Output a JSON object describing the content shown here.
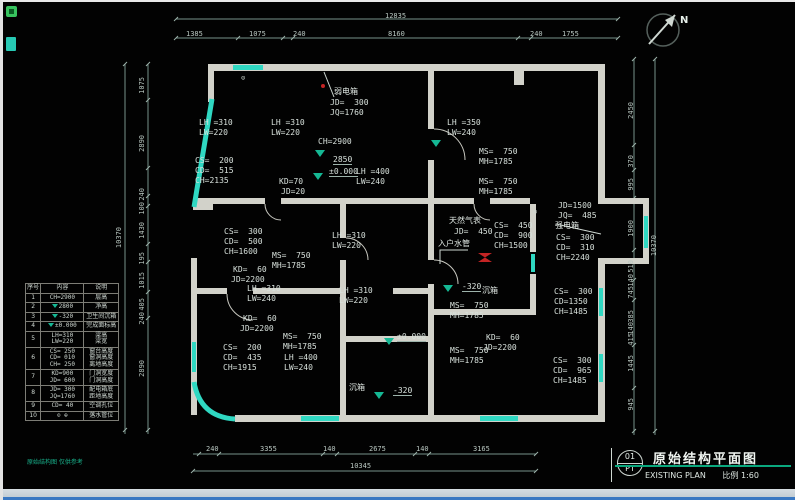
{
  "colors": {
    "background": "#020202",
    "wall": "#d2d2ca",
    "teal_accent": "#2fd8c2",
    "dim_line": "#77928a",
    "dim_text": "#b9c7c1",
    "level_green": "#15b894",
    "title_green": "#0aa87e",
    "alert_red": "#c42424"
  },
  "titleblock": {
    "number": "01",
    "code": "PT",
    "title_cn": "原始结构平面图",
    "title_en": "EXISTING PLAN",
    "scale_label": "比例 1:60"
  },
  "legend": {
    "headers": [
      "序号",
      "内容",
      "说明"
    ],
    "rows": [
      {
        "no": "1",
        "icon": null,
        "content": [
          "CH=2900"
        ],
        "desc": [
          "层高"
        ]
      },
      {
        "no": "2",
        "icon": "level-triangle",
        "content": [
          "2800"
        ],
        "desc": [
          "净高"
        ]
      },
      {
        "no": "3",
        "icon": "level-triangle",
        "content": [
          "-320"
        ],
        "desc": [
          "卫生间沉箱"
        ]
      },
      {
        "no": "4",
        "icon": "level-triangle",
        "content": [
          "±0.000"
        ],
        "desc": [
          "完成面标高"
        ]
      },
      {
        "no": "5",
        "icon": null,
        "content": [
          "LH=310",
          "LW=220"
        ],
        "desc": [
          "梁高",
          "梁宽"
        ]
      },
      {
        "no": "6",
        "icon": null,
        "content": [
          "CS= 250",
          "CD= 010",
          "CH= 250"
        ],
        "desc": [
          "窗台高度",
          "窗洞高度",
          "离地高度"
        ]
      },
      {
        "no": "7",
        "icon": null,
        "content": [
          "KD=900",
          "JD= 600"
        ],
        "desc": [
          "门洞宽度",
          "门洞高度"
        ]
      },
      {
        "no": "8",
        "icon": null,
        "content": [
          "JD= 300",
          "JQ=1760"
        ],
        "desc": [
          "配电箱底",
          "距地高度"
        ]
      },
      {
        "no": "9",
        "icon": null,
        "content": [
          "CD= 40"
        ],
        "desc": [
          "空调孔位"
        ]
      },
      {
        "no": "10",
        "icon": null,
        "content": [
          "⊙ ⊕"
        ],
        "desc": [
          "落水管位"
        ]
      }
    ],
    "note": "原始结构图 仅供参考"
  },
  "labels": [
    {
      "t": "12835",
      "x": 382,
      "y": 10,
      "c": "dim",
      "n": "dim-top-total"
    },
    {
      "t": "1385",
      "x": 183,
      "y": 28,
      "c": "dim",
      "n": "dim-top"
    },
    {
      "t": "1075",
      "x": 246,
      "y": 28,
      "c": "dim",
      "n": "dim-top"
    },
    {
      "t": "240",
      "x": 290,
      "y": 28,
      "c": "dim",
      "n": "dim-top"
    },
    {
      "t": "8160",
      "x": 385,
      "y": 28,
      "c": "dim",
      "n": "dim-top"
    },
    {
      "t": "240",
      "x": 527,
      "y": 28,
      "c": "dim",
      "n": "dim-top"
    },
    {
      "t": "1755",
      "x": 559,
      "y": 28,
      "c": "dim",
      "n": "dim-top"
    },
    {
      "t": "240",
      "x": 203,
      "y": 443,
      "c": "dim",
      "n": "dim-bottom"
    },
    {
      "t": "3355",
      "x": 257,
      "y": 443,
      "c": "dim",
      "n": "dim-bottom"
    },
    {
      "t": "140",
      "x": 320,
      "y": 443,
      "c": "dim",
      "n": "dim-bottom"
    },
    {
      "t": "2675",
      "x": 366,
      "y": 443,
      "c": "dim",
      "n": "dim-bottom"
    },
    {
      "t": "140",
      "x": 413,
      "y": 443,
      "c": "dim",
      "n": "dim-bottom"
    },
    {
      "t": "3165",
      "x": 470,
      "y": 443,
      "c": "dim",
      "n": "dim-bottom"
    },
    {
      "t": "10345",
      "x": 347,
      "y": 460,
      "c": "dim",
      "n": "dim-bottom-total"
    },
    {
      "t": "10370",
      "x": 112,
      "y": 225,
      "c": "dimv",
      "n": "dim-left-total"
    },
    {
      "t": "1075",
      "x": 135,
      "y": 75,
      "c": "dimv",
      "n": "dim-left"
    },
    {
      "t": "2890",
      "x": 135,
      "y": 133,
      "c": "dimv",
      "n": "dim-left"
    },
    {
      "t": "240",
      "x": 135,
      "y": 186,
      "c": "dimv",
      "n": "dim-left"
    },
    {
      "t": "100",
      "x": 135,
      "y": 200,
      "c": "dimv",
      "n": "dim-left"
    },
    {
      "t": "1430",
      "x": 135,
      "y": 220,
      "c": "dimv",
      "n": "dim-left"
    },
    {
      "t": "195",
      "x": 135,
      "y": 250,
      "c": "dimv",
      "n": "dim-left"
    },
    {
      "t": "1015",
      "x": 135,
      "y": 270,
      "c": "dimv",
      "n": "dim-left"
    },
    {
      "t": "405",
      "x": 135,
      "y": 296,
      "c": "dimv",
      "n": "dim-left"
    },
    {
      "t": "240",
      "x": 135,
      "y": 310,
      "c": "dimv",
      "n": "dim-left"
    },
    {
      "t": "2890",
      "x": 135,
      "y": 358,
      "c": "dimv",
      "n": "dim-left"
    },
    {
      "t": "2450",
      "x": 624,
      "y": 100,
      "c": "dimv",
      "n": "dim-right"
    },
    {
      "t": "370",
      "x": 624,
      "y": 153,
      "c": "dimv",
      "n": "dim-right"
    },
    {
      "t": "995",
      "x": 624,
      "y": 176,
      "c": "dimv",
      "n": "dim-right"
    },
    {
      "t": "1900",
      "x": 624,
      "y": 218,
      "c": "dimv",
      "n": "dim-right"
    },
    {
      "t": "510",
      "x": 624,
      "y": 258,
      "c": "dimv",
      "n": "dim-right"
    },
    {
      "t": "140",
      "x": 624,
      "y": 272,
      "c": "dimv",
      "n": "dim-right"
    },
    {
      "t": "745",
      "x": 624,
      "y": 284,
      "c": "dimv",
      "n": "dim-right"
    },
    {
      "t": "385",
      "x": 624,
      "y": 308,
      "c": "dimv",
      "n": "dim-right"
    },
    {
      "t": "140",
      "x": 624,
      "y": 320,
      "c": "dimv",
      "n": "dim-right"
    },
    {
      "t": "415",
      "x": 624,
      "y": 331,
      "c": "dimv",
      "n": "dim-right"
    },
    {
      "t": "1445",
      "x": 624,
      "y": 353,
      "c": "dimv",
      "n": "dim-right"
    },
    {
      "t": "945",
      "x": 624,
      "y": 396,
      "c": "dimv",
      "n": "dim-right"
    },
    {
      "t": "10370",
      "x": 647,
      "y": 233,
      "c": "dimv",
      "n": "dim-right-total"
    },
    {
      "t": "弱电箱",
      "x": 331,
      "y": 85,
      "c": "cn",
      "n": "annotation-weak-current-box"
    },
    {
      "t": "JD=  300",
      "x": 327,
      "y": 96,
      "c": "",
      "n": "annotation"
    },
    {
      "t": "JQ=1760",
      "x": 327,
      "y": 106,
      "c": "",
      "n": "annotation"
    },
    {
      "t": "LH =310",
      "x": 196,
      "y": 116,
      "c": "",
      "n": "annotation"
    },
    {
      "t": "LW=220",
      "x": 196,
      "y": 126,
      "c": "",
      "n": "annotation"
    },
    {
      "t": "LH =310",
      "x": 268,
      "y": 116,
      "c": "",
      "n": "annotation"
    },
    {
      "t": "LW=220",
      "x": 268,
      "y": 126,
      "c": "",
      "n": "annotation"
    },
    {
      "t": "LH =350",
      "x": 444,
      "y": 116,
      "c": "",
      "n": "annotation"
    },
    {
      "t": "LW=240",
      "x": 444,
      "y": 126,
      "c": "",
      "n": "annotation"
    },
    {
      "t": "CH=2900",
      "x": 315,
      "y": 135,
      "c": "",
      "n": "annotation"
    },
    {
      "t": "2850",
      "x": 330,
      "y": 153,
      "c": "lvl",
      "n": "level-label"
    },
    {
      "t": "±0.000",
      "x": 326,
      "y": 165,
      "c": "lvl",
      "n": "level-label"
    },
    {
      "t": "CS=  200",
      "x": 192,
      "y": 154,
      "c": "",
      "n": "annotation"
    },
    {
      "t": "CD=  515",
      "x": 192,
      "y": 164,
      "c": "",
      "n": "annotation"
    },
    {
      "t": "CH=2135",
      "x": 192,
      "y": 174,
      "c": "",
      "n": "annotation"
    },
    {
      "t": "KD=70",
      "x": 276,
      "y": 175,
      "c": "",
      "n": "annotation"
    },
    {
      "t": "JD=20",
      "x": 278,
      "y": 185,
      "c": "",
      "n": "annotation"
    },
    {
      "t": "LH =400",
      "x": 353,
      "y": 165,
      "c": "",
      "n": "annotation"
    },
    {
      "t": "LW=240",
      "x": 353,
      "y": 175,
      "c": "",
      "n": "annotation"
    },
    {
      "t": "MS=  750",
      "x": 476,
      "y": 145,
      "c": "",
      "n": "annotation"
    },
    {
      "t": "MH=1785",
      "x": 476,
      "y": 155,
      "c": "",
      "n": "annotation"
    },
    {
      "t": "MS=  750",
      "x": 476,
      "y": 175,
      "c": "",
      "n": "annotation"
    },
    {
      "t": "MH=1785",
      "x": 476,
      "y": 185,
      "c": "",
      "n": "annotation"
    },
    {
      "t": "CS=  300",
      "x": 221,
      "y": 225,
      "c": "",
      "n": "annotation"
    },
    {
      "t": "CD=  500",
      "x": 221,
      "y": 235,
      "c": "",
      "n": "annotation"
    },
    {
      "t": "CH=1600",
      "x": 221,
      "y": 245,
      "c": "",
      "n": "annotation"
    },
    {
      "t": "LH =310",
      "x": 329,
      "y": 229,
      "c": "",
      "n": "annotation"
    },
    {
      "t": "LW=220",
      "x": 329,
      "y": 239,
      "c": "",
      "n": "annotation"
    },
    {
      "t": "MS=  750",
      "x": 269,
      "y": 249,
      "c": "",
      "n": "annotation"
    },
    {
      "t": "MH=1785",
      "x": 269,
      "y": 259,
      "c": "",
      "n": "annotation"
    },
    {
      "t": "KD=  60",
      "x": 230,
      "y": 263,
      "c": "",
      "n": "annotation"
    },
    {
      "t": "JD=2200",
      "x": 228,
      "y": 273,
      "c": "",
      "n": "annotation"
    },
    {
      "t": "天然气表",
      "x": 446,
      "y": 214,
      "c": "cn",
      "n": "annotation-gas-meter"
    },
    {
      "t": "JD=  450",
      "x": 451,
      "y": 225,
      "c": "",
      "n": "annotation"
    },
    {
      "t": "入户水管",
      "x": 435,
      "y": 237,
      "c": "cn",
      "n": "annotation-water-inlet"
    },
    {
      "t": "CS=  450",
      "x": 491,
      "y": 219,
      "c": "",
      "n": "annotation"
    },
    {
      "t": "CD=  900",
      "x": 491,
      "y": 229,
      "c": "",
      "n": "annotation"
    },
    {
      "t": "CH=1500",
      "x": 491,
      "y": 239,
      "c": "",
      "n": "annotation"
    },
    {
      "t": "JD=1500",
      "x": 555,
      "y": 199,
      "c": "",
      "n": "annotation"
    },
    {
      "t": "JQ=  485",
      "x": 555,
      "y": 209,
      "c": "",
      "n": "annotation"
    },
    {
      "t": "强电箱",
      "x": 552,
      "y": 219,
      "c": "cn",
      "n": "annotation-strong-current-box"
    },
    {
      "t": "CS=  300",
      "x": 553,
      "y": 231,
      "c": "",
      "n": "annotation"
    },
    {
      "t": "CD=  310",
      "x": 553,
      "y": 241,
      "c": "",
      "n": "annotation"
    },
    {
      "t": "CH=2240",
      "x": 553,
      "y": 251,
      "c": "",
      "n": "annotation"
    },
    {
      "t": "LH =310",
      "x": 244,
      "y": 282,
      "c": "",
      "n": "annotation"
    },
    {
      "t": "LW=240",
      "x": 244,
      "y": 292,
      "c": "",
      "n": "annotation"
    },
    {
      "t": "LH =310",
      "x": 336,
      "y": 284,
      "c": "",
      "n": "annotation"
    },
    {
      "t": "LW=220",
      "x": 336,
      "y": 294,
      "c": "",
      "n": "annotation"
    },
    {
      "t": "KD=  60",
      "x": 240,
      "y": 312,
      "c": "",
      "n": "annotation"
    },
    {
      "t": "JD=2200",
      "x": 237,
      "y": 322,
      "c": "",
      "n": "annotation"
    },
    {
      "t": "-320",
      "x": 459,
      "y": 280,
      "c": "lvl",
      "n": "level-label"
    },
    {
      "t": "沉箱",
      "x": 479,
      "y": 284,
      "c": "cn",
      "n": "annotation-sunken-box"
    },
    {
      "t": "MS=  750",
      "x": 447,
      "y": 299,
      "c": "",
      "n": "annotation"
    },
    {
      "t": "MH=1785",
      "x": 447,
      "y": 309,
      "c": "",
      "n": "annotation"
    },
    {
      "t": "CS=  300",
      "x": 551,
      "y": 285,
      "c": "",
      "n": "annotation"
    },
    {
      "t": "CD=1350",
      "x": 551,
      "y": 295,
      "c": "",
      "n": "annotation"
    },
    {
      "t": "CH=1485",
      "x": 551,
      "y": 305,
      "c": "",
      "n": "annotation"
    },
    {
      "t": "MS=  750",
      "x": 280,
      "y": 330,
      "c": "",
      "n": "annotation"
    },
    {
      "t": "MH=1785",
      "x": 280,
      "y": 340,
      "c": "",
      "n": "annotation"
    },
    {
      "t": "CS=  200",
      "x": 220,
      "y": 341,
      "c": "",
      "n": "annotation"
    },
    {
      "t": "CD=  435",
      "x": 220,
      "y": 351,
      "c": "",
      "n": "annotation"
    },
    {
      "t": "CH=1915",
      "x": 220,
      "y": 361,
      "c": "",
      "n": "annotation"
    },
    {
      "t": "LH =400",
      "x": 281,
      "y": 351,
      "c": "",
      "n": "annotation"
    },
    {
      "t": "LW=240",
      "x": 281,
      "y": 361,
      "c": "",
      "n": "annotation"
    },
    {
      "t": "±0.000",
      "x": 394,
      "y": 330,
      "c": "lvl",
      "n": "level-label"
    },
    {
      "t": "KD=  60",
      "x": 483,
      "y": 331,
      "c": "",
      "n": "annotation"
    },
    {
      "t": "JD=2200",
      "x": 480,
      "y": 341,
      "c": "",
      "n": "annotation"
    },
    {
      "t": "MS=  750",
      "x": 447,
      "y": 344,
      "c": "",
      "n": "annotation"
    },
    {
      "t": "MH=1785",
      "x": 447,
      "y": 354,
      "c": "",
      "n": "annotation"
    },
    {
      "t": "CS=  300",
      "x": 550,
      "y": 354,
      "c": "",
      "n": "annotation"
    },
    {
      "t": "CD=  965",
      "x": 550,
      "y": 364,
      "c": "",
      "n": "annotation"
    },
    {
      "t": "CH=1485",
      "x": 550,
      "y": 374,
      "c": "",
      "n": "annotation"
    },
    {
      "t": "沉箱",
      "x": 346,
      "y": 381,
      "c": "cn",
      "n": "annotation-sunken-box"
    },
    {
      "t": "-320",
      "x": 390,
      "y": 384,
      "c": "lvl",
      "n": "level-label"
    },
    {
      "t": "⊙",
      "x": 238,
      "y": 72,
      "c": "sym",
      "n": "drain-symbol-icon"
    },
    {
      "t": "⊙",
      "x": 530,
      "y": 206,
      "c": "sym",
      "n": "drain-symbol-icon"
    },
    {
      "t": "N",
      "x": 677,
      "y": 14,
      "c": "north",
      "n": "north-label"
    }
  ],
  "markers": [
    {
      "type": "tri",
      "x": 312,
      "y": 148,
      "n": "level-triangle-icon"
    },
    {
      "type": "tri",
      "x": 310,
      "y": 171,
      "n": "level-triangle-icon"
    },
    {
      "type": "tri",
      "x": 428,
      "y": 138,
      "n": "level-triangle-icon"
    },
    {
      "type": "tri",
      "x": 440,
      "y": 283,
      "n": "level-triangle-icon"
    },
    {
      "type": "tri",
      "x": 381,
      "y": 336,
      "n": "level-triangle-icon"
    },
    {
      "type": "tri",
      "x": 371,
      "y": 390,
      "n": "level-triangle-icon"
    },
    {
      "type": "valve",
      "x": 475,
      "y": 251,
      "n": "valve-icon"
    },
    {
      "type": "dot",
      "x": 318,
      "y": 82,
      "n": "red-dot"
    }
  ]
}
